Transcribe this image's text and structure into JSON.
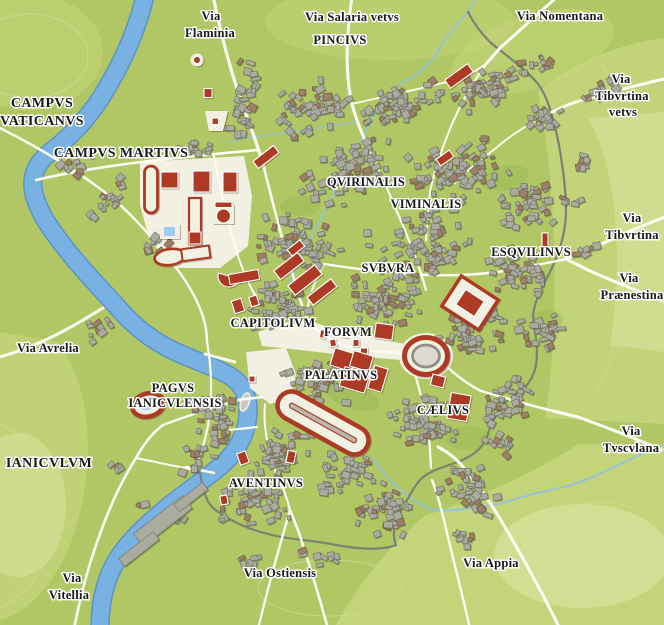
{
  "map_title": "Map of ancient Rome",
  "colors": {
    "land": "#b1c765",
    "land_light": "#c8d67f",
    "land_lighter": "#dae29f",
    "garden": "#9cba58",
    "contour": "#cfdb90",
    "river": "#79b2e2",
    "river_edge": "#5b93c5",
    "stream": "#8dc0ea",
    "pool": "#a3cbee",
    "road": "#fdfcf3",
    "wall": "#7d8172",
    "building": "#acaba0",
    "building_edge": "#6f6f64",
    "building_alt": "#9d8166",
    "monument": "#ac3a24",
    "monument_dark": "#8a2b1a",
    "plaza": "#f2f0e3",
    "label": "#1a1a1a",
    "halo": "#ffffff"
  },
  "labels": [
    {
      "id": "via-flaminia",
      "kind": "road",
      "lines": [
        {
          "text": "Via",
          "x": 211,
          "y": 20
        },
        {
          "text": "Flaminia",
          "x": 210,
          "y": 37
        }
      ]
    },
    {
      "id": "via-salaria-vetvs",
      "kind": "road",
      "lines": [
        {
          "text": "Via Salaria vetvs",
          "x": 352,
          "y": 21
        }
      ]
    },
    {
      "id": "pincivs",
      "kind": "region",
      "lines": [
        {
          "text": "PINCIVS",
          "x": 340,
          "y": 44
        }
      ]
    },
    {
      "id": "via-nomentana",
      "kind": "road",
      "lines": [
        {
          "text": "Via Nomentana",
          "x": 560,
          "y": 20
        }
      ]
    },
    {
      "id": "via-tibvrtina-vetvs",
      "kind": "road",
      "lines": [
        {
          "text": "Via",
          "x": 621,
          "y": 83
        },
        {
          "text": "Tibvrtina",
          "x": 622,
          "y": 100
        },
        {
          "text": "vetvs",
          "x": 623,
          "y": 116
        }
      ]
    },
    {
      "id": "campvs-vaticanvs",
      "kind": "region",
      "big": true,
      "lines": [
        {
          "text": "CAMPVS",
          "x": 42,
          "y": 107
        },
        {
          "text": "VATICANVS",
          "x": 42,
          "y": 125
        }
      ]
    },
    {
      "id": "campvs-martivs",
      "kind": "region",
      "big": true,
      "lines": [
        {
          "text": "CAMPVS MARTIVS",
          "x": 121,
          "y": 157
        }
      ]
    },
    {
      "id": "qvirinalis",
      "kind": "region",
      "lines": [
        {
          "text": "QVIRINALIS",
          "x": 366,
          "y": 186
        }
      ]
    },
    {
      "id": "viminalis",
      "kind": "region",
      "lines": [
        {
          "text": "VIMINALIS",
          "x": 426,
          "y": 208
        }
      ]
    },
    {
      "id": "svbvra",
      "kind": "region",
      "lines": [
        {
          "text": "SVBVRA",
          "x": 388,
          "y": 272
        }
      ]
    },
    {
      "id": "esqvilinvs",
      "kind": "region",
      "lines": [
        {
          "text": "ESQVILINVS",
          "x": 531,
          "y": 256
        }
      ]
    },
    {
      "id": "via-tibvrtina",
      "kind": "road",
      "lines": [
        {
          "text": "Via",
          "x": 632,
          "y": 222
        },
        {
          "text": "Tibvrtina",
          "x": 632,
          "y": 239
        }
      ]
    },
    {
      "id": "via-praenestina",
      "kind": "road",
      "lines": [
        {
          "text": "Via",
          "x": 629,
          "y": 282
        },
        {
          "text": "Prænestina",
          "x": 632,
          "y": 299
        }
      ]
    },
    {
      "id": "capitolivm",
      "kind": "region",
      "lines": [
        {
          "text": "CAPITOLIVM",
          "x": 273,
          "y": 327
        }
      ]
    },
    {
      "id": "forvm",
      "kind": "region",
      "lines": [
        {
          "text": "FORVM",
          "x": 348,
          "y": 336
        }
      ]
    },
    {
      "id": "palatinvs",
      "kind": "region",
      "lines": [
        {
          "text": "PALATINVS",
          "x": 341,
          "y": 379
        }
      ]
    },
    {
      "id": "caelivs",
      "kind": "region",
      "lines": [
        {
          "text": "CÆLIVS",
          "x": 443,
          "y": 414
        }
      ]
    },
    {
      "id": "via-avrelia",
      "kind": "road",
      "lines": [
        {
          "text": "Via Avrelia",
          "x": 48,
          "y": 352
        }
      ]
    },
    {
      "id": "pagvs-ianicvlensis",
      "kind": "region",
      "lines": [
        {
          "text": "PAGVS",
          "x": 173,
          "y": 392
        },
        {
          "text": "IANICVLENSIS",
          "x": 175,
          "y": 407
        }
      ]
    },
    {
      "id": "ianicvlvm",
      "kind": "region",
      "big": true,
      "lines": [
        {
          "text": "IANICVLVM",
          "x": 49,
          "y": 467
        }
      ]
    },
    {
      "id": "aventinvs",
      "kind": "region",
      "lines": [
        {
          "text": "AVENTINVS",
          "x": 266,
          "y": 487
        }
      ]
    },
    {
      "id": "via-ostiensis",
      "kind": "road",
      "lines": [
        {
          "text": "Via Ostiensis",
          "x": 280,
          "y": 577
        }
      ]
    },
    {
      "id": "via-appia",
      "kind": "road",
      "lines": [
        {
          "text": "Via Appia",
          "x": 491,
          "y": 567
        }
      ]
    },
    {
      "id": "via-tvscvlana",
      "kind": "road",
      "lines": [
        {
          "text": "Via",
          "x": 631,
          "y": 435
        },
        {
          "text": "Tvscvlana",
          "x": 631,
          "y": 452
        }
      ]
    },
    {
      "id": "via-vitellia",
      "kind": "road",
      "lines": [
        {
          "text": "Via",
          "x": 72,
          "y": 582
        },
        {
          "text": "Vitellia",
          "x": 69,
          "y": 599
        }
      ]
    }
  ]
}
